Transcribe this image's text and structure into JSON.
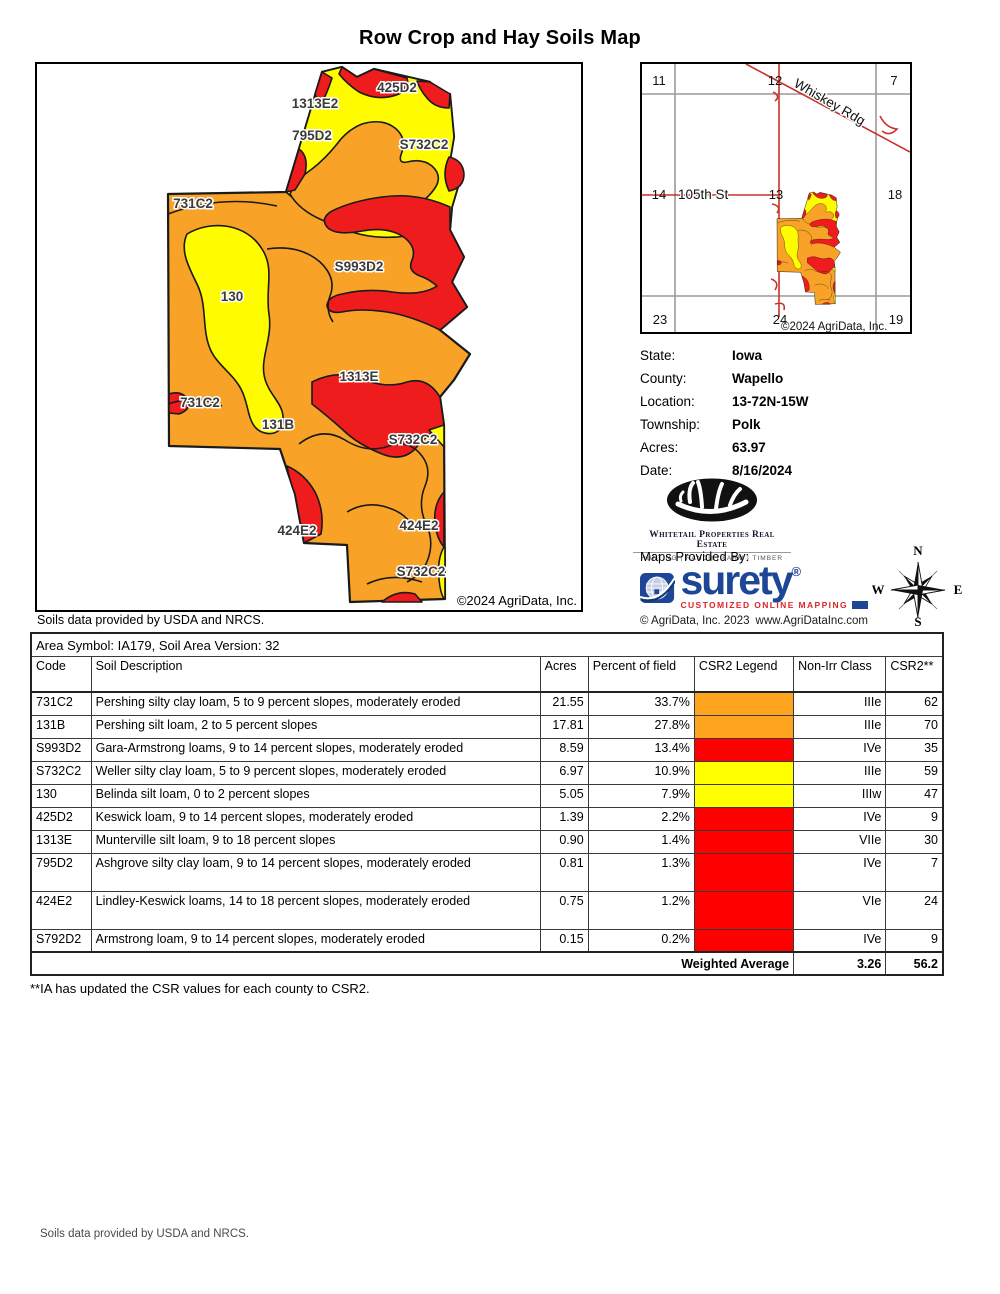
{
  "title": "Row Crop and Hay Soils Map",
  "main_map": {
    "attribution": "©2024 AgriData, Inc.",
    "labels": [
      {
        "text": "425D2",
        "x": 360,
        "y": 28
      },
      {
        "text": "1313E2",
        "x": 278,
        "y": 44
      },
      {
        "text": "795D2",
        "x": 275,
        "y": 76
      },
      {
        "text": "S732C2",
        "x": 387,
        "y": 85
      },
      {
        "text": "731C2",
        "x": 156,
        "y": 144
      },
      {
        "text": "S993D2",
        "x": 322,
        "y": 207
      },
      {
        "text": "130",
        "x": 195,
        "y": 237
      },
      {
        "text": "1313E",
        "x": 322,
        "y": 317
      },
      {
        "text": "731C2",
        "x": 163,
        "y": 343
      },
      {
        "text": "131B",
        "x": 241,
        "y": 365
      },
      {
        "text": "S732C2",
        "x": 376,
        "y": 380
      },
      {
        "text": "424E2",
        "x": 260,
        "y": 471
      },
      {
        "text": "424E2",
        "x": 382,
        "y": 466
      },
      {
        "text": "S732C2",
        "x": 384,
        "y": 512
      }
    ]
  },
  "soils_note_top": "Soils data provided by USDA and NRCS.",
  "locator_map": {
    "sections": [
      {
        "text": "11",
        "x": 17,
        "y": 21
      },
      {
        "text": "12",
        "x": 133,
        "y": 21
      },
      {
        "text": "7",
        "x": 252,
        "y": 21
      },
      {
        "text": "14",
        "x": 17,
        "y": 135
      },
      {
        "text": "13",
        "x": 134,
        "y": 135
      },
      {
        "text": "18",
        "x": 253,
        "y": 135
      },
      {
        "text": "23",
        "x": 18,
        "y": 260
      },
      {
        "text": "24",
        "x": 138,
        "y": 260
      },
      {
        "text": "19",
        "x": 254,
        "y": 260
      }
    ],
    "road_diagonal": "Whiskey Rdg",
    "road_horizontal": "105th St",
    "attribution": "©2024 AgriData, Inc."
  },
  "info": {
    "rows": [
      {
        "label": "State:",
        "value": "Iowa"
      },
      {
        "label": "County:",
        "value": "Wapello"
      },
      {
        "label": "Location:",
        "value": "13-72N-15W"
      },
      {
        "label": "Township:",
        "value": "Polk"
      },
      {
        "label": "Acres:",
        "value": "63.97"
      },
      {
        "label": "Date:",
        "value": "8/16/2024"
      }
    ]
  },
  "branding": {
    "whitetail_name": "Whitetail Properties Real Estate",
    "whitetail_tagline": "HUNTING  |  RANCH  |  FARM  |  TIMBER",
    "maps_provided_by": "Maps Provided By:",
    "surety_name": "surety",
    "surety_reg": "®",
    "surety_tagline": "CUSTOMIZED ONLINE MAPPING",
    "surety_copyright": "© AgriData, Inc. 2023",
    "surety_website": "www.AgriDataInc.com",
    "compass": {
      "n": "N",
      "e": "E",
      "s": "S",
      "w": "W"
    }
  },
  "table": {
    "area_header": "Area Symbol: IA179, Soil Area Version: 32",
    "columns": [
      "Code",
      "Soil Description",
      "Acres",
      "Percent of field",
      "CSR2 Legend",
      "Non-Irr Class",
      "CSR2**"
    ],
    "rows": [
      {
        "code": "731C2",
        "description": "Pershing silty clay loam, 5 to 9 percent slopes, moderately eroded",
        "acres": "21.55",
        "percent": "33.7%",
        "legend_color": "#FFA41E",
        "non_irr_class": "IIIe",
        "csr2": "62",
        "tall": false
      },
      {
        "code": "131B",
        "description": "Pershing silt loam, 2 to 5 percent slopes",
        "acres": "17.81",
        "percent": "27.8%",
        "legend_color": "#FFA41E",
        "non_irr_class": "IIIe",
        "csr2": "70",
        "tall": false
      },
      {
        "code": "S993D2",
        "description": "Gara-Armstrong loams, 9 to 14 percent slopes, moderately eroded",
        "acres": "8.59",
        "percent": "13.4%",
        "legend_color": "#FF0000",
        "non_irr_class": "IVe",
        "csr2": "35",
        "tall": false
      },
      {
        "code": "S732C2",
        "description": "Weller silty clay loam, 5 to 9 percent slopes, moderately eroded",
        "acres": "6.97",
        "percent": "10.9%",
        "legend_color": "#FFFF00",
        "non_irr_class": "IIIe",
        "csr2": "59",
        "tall": false
      },
      {
        "code": "130",
        "description": "Belinda silt loam, 0 to 2 percent slopes",
        "acres": "5.05",
        "percent": "7.9%",
        "legend_color": "#FFFF00",
        "non_irr_class": "IIIw",
        "csr2": "47",
        "tall": false
      },
      {
        "code": "425D2",
        "description": "Keswick loam, 9 to 14 percent slopes, moderately eroded",
        "acres": "1.39",
        "percent": "2.2%",
        "legend_color": "#FF0000",
        "non_irr_class": "IVe",
        "csr2": "9",
        "tall": false
      },
      {
        "code": "1313E",
        "description": "Munterville silt loam, 9 to 18 percent slopes",
        "acres": "0.90",
        "percent": "1.4%",
        "legend_color": "#FF0000",
        "non_irr_class": "VIIe",
        "csr2": "30",
        "tall": false
      },
      {
        "code": "795D2",
        "description": "Ashgrove silty clay loam, 9 to 14 percent slopes, moderately eroded",
        "acres": "0.81",
        "percent": "1.3%",
        "legend_color": "#FF0000",
        "non_irr_class": "IVe",
        "csr2": "7",
        "tall": true
      },
      {
        "code": "424E2",
        "description": "Lindley-Keswick loams, 14 to 18 percent slopes, moderately eroded",
        "acres": "0.75",
        "percent": "1.2%",
        "legend_color": "#FF0000",
        "non_irr_class": "VIe",
        "csr2": "24",
        "tall": true
      },
      {
        "code": "S792D2",
        "description": "Armstrong loam, 9 to 14 percent slopes, moderately eroded",
        "acres": "0.15",
        "percent": "0.2%",
        "legend_color": "#FF0000",
        "non_irr_class": "IVe",
        "csr2": "9",
        "tall": false
      }
    ],
    "weighted_average": {
      "label": "Weighted Average",
      "value1": "3.26",
      "value2": "56.2"
    }
  },
  "footnote": "**IA has updated the CSR values for each county to CSR2.",
  "soils_note_bottom": "Soils data provided by USDA and NRCS.",
  "colors": {
    "map_orange": "#F8A327",
    "map_red": "#EE1C1C",
    "map_yellow": "#FFFC00",
    "table_orange": "#FFA41E",
    "table_red": "#FF0000",
    "table_yellow": "#FFFF00",
    "road_red": "#C9312B",
    "surety_blue": "#1D4697",
    "surety_red": "#D9252A"
  }
}
